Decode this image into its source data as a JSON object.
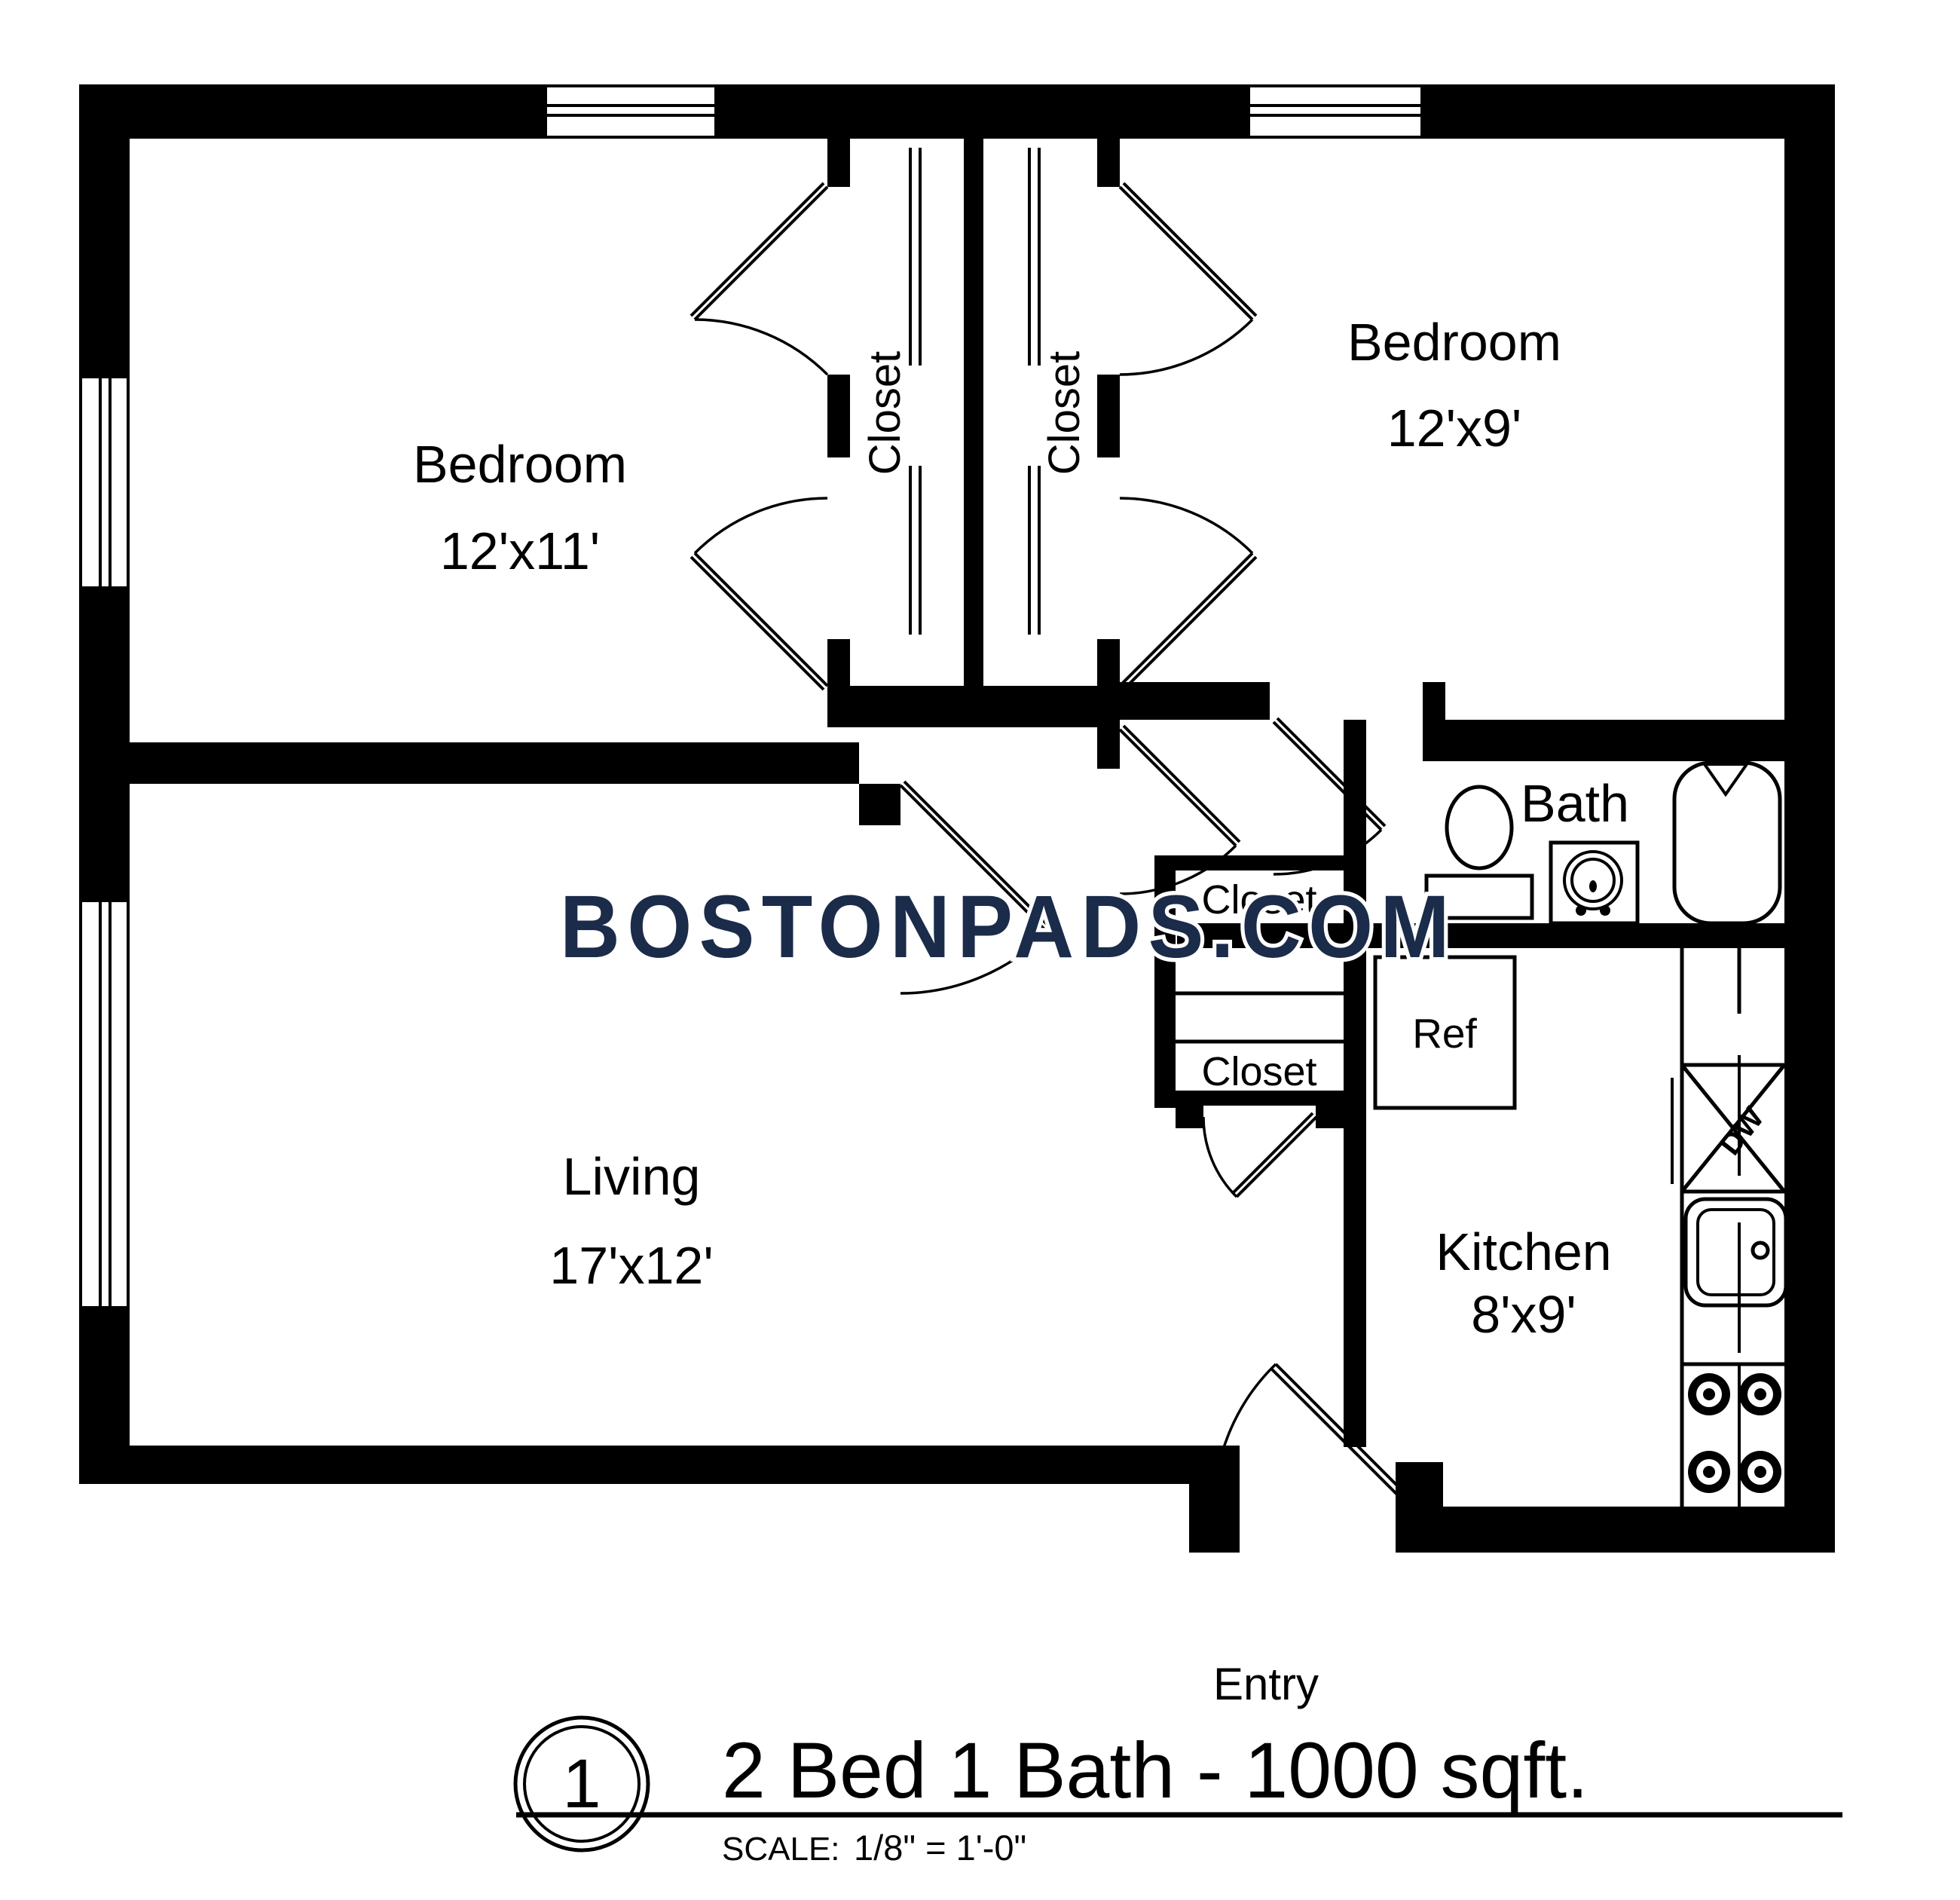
{
  "watermark": {
    "text": "BOSTONPADS.COM",
    "color": "#1b2b4a"
  },
  "rooms": {
    "bedroom1": {
      "name": "Bedroom",
      "dims": "12'x11'"
    },
    "bedroom2": {
      "name": "Bedroom",
      "dims": "12'x9'"
    },
    "living": {
      "name": "Living",
      "dims": "17'x12'"
    },
    "kitchen": {
      "name": "Kitchen",
      "dims": "8'x9'"
    },
    "bath": {
      "name": "Bath"
    }
  },
  "closets": {
    "bedroom1_closet": "Closet",
    "bedroom2_closet": "Closet",
    "hall_closet_upper": "Closet",
    "hall_closet_lower": "Closet"
  },
  "fixtures": {
    "refrigerator": "Ref",
    "dishwasher": "DW"
  },
  "entry": {
    "label": "Entry"
  },
  "title_block": {
    "unit_number": "1",
    "title": "2 Bed 1 Bath - 1000 sqft.",
    "scale_label": "SCALE:",
    "scale_value": "1/8\" = 1'-0\""
  },
  "colors": {
    "wall": "#000000",
    "background": "#ffffff",
    "watermark": "#1b2b4a"
  }
}
